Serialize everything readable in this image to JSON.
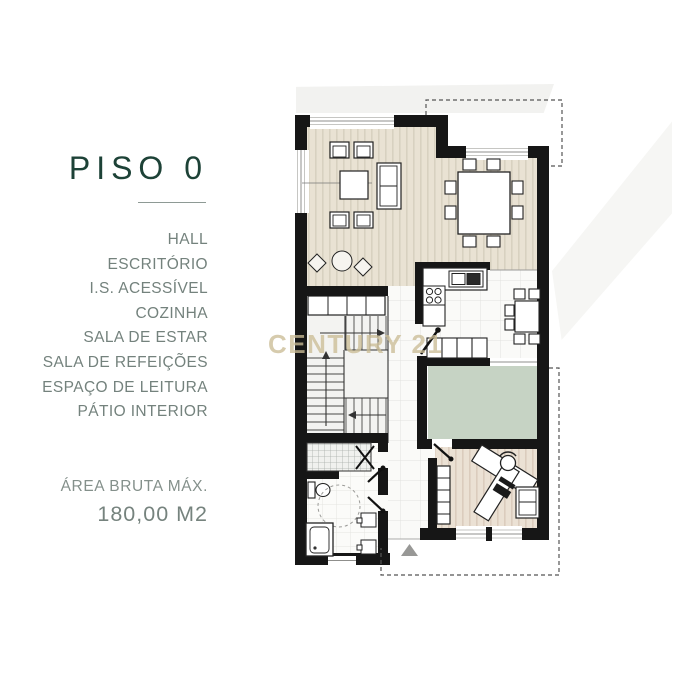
{
  "panel": {
    "title": "PISO 0",
    "rooms": [
      "HALL",
      "ESCRITÓRIO",
      "I.S. ACESSÍVEL",
      "COZINHA",
      "SALA DE ESTAR",
      "SALA DE REFEIÇÕES",
      "ESPAÇO DE LEITURA",
      "PÁTIO INTERIOR"
    ],
    "area_label": "ÁREA BRUTA MÁX.",
    "area_value": "180,00 M2"
  },
  "watermark": {
    "text": "CENTURY 21"
  },
  "colors": {
    "title_green": "#1d4237",
    "list_gray": "#74827d",
    "watermark_gold": "#cbbc96",
    "wall_black": "#161616",
    "wood_floor": "#e9e2d3",
    "office_floor": "#ebe1d4",
    "patio_green": "#c6d3c4",
    "tile_white": "#fafaf8"
  },
  "floor_plan": {
    "furniture": [
      "sofa",
      "armchair",
      "coffee-table",
      "rug-decor",
      "dining-table",
      "dining-chair",
      "kitchen-counter",
      "kitchen-sink",
      "cooktop",
      "kitchen-table",
      "wardrobe",
      "staircase",
      "toilet",
      "accessible-turning-circle",
      "bathtub",
      "washbasin",
      "shower-area",
      "desk",
      "desk-chair",
      "bookshelf",
      "cabinet",
      "entrance-arrow",
      "patio",
      "property-boundary"
    ]
  }
}
